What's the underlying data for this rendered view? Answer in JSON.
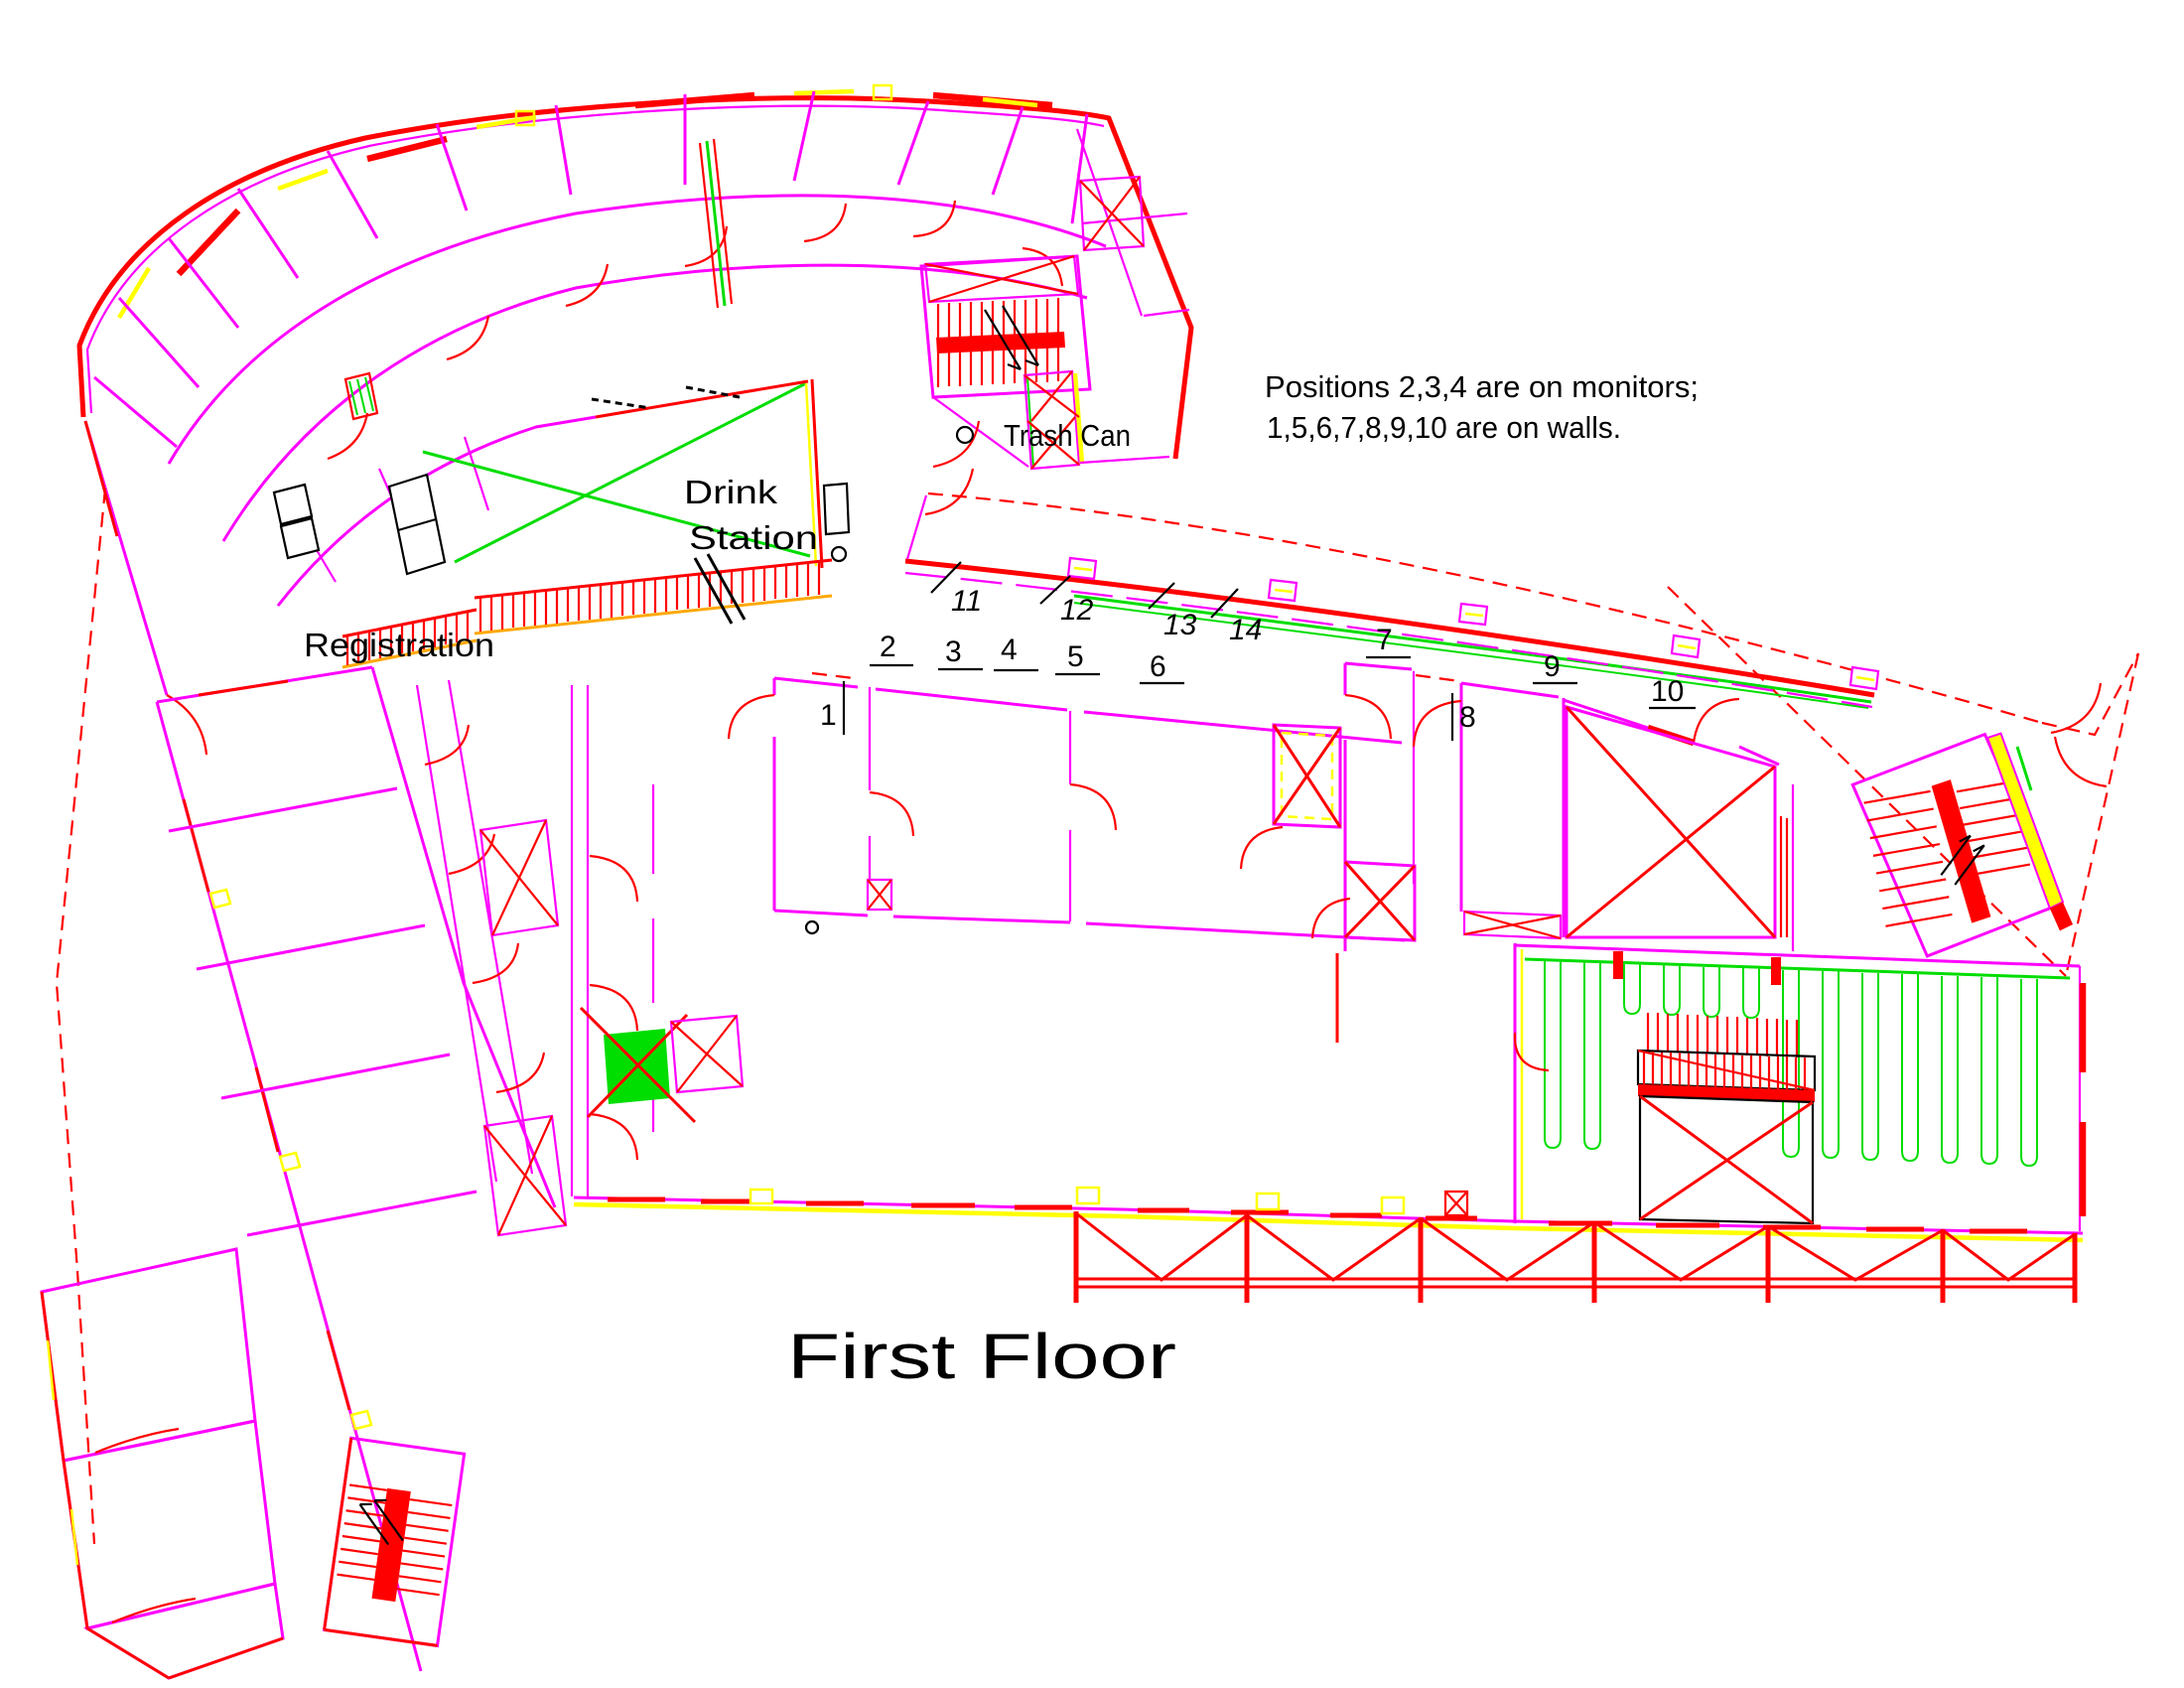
{
  "drawing_title": "First Floor",
  "notes": {
    "line1": "Positions 2,3,4 are on monitors;",
    "line2": "1,5,6,7,8,9,10 are on walls."
  },
  "legend": {
    "trash_can_label": "Trash Can"
  },
  "rooms": {
    "registration_label": "Registration",
    "drink_station_line1": "Drink",
    "drink_station_line2": "Station"
  },
  "positions": {
    "p1": "1",
    "p2": "2",
    "p3": "3",
    "p4": "4",
    "p5": "5",
    "p6": "6",
    "p7": "7",
    "p8": "8",
    "p9": "9",
    "p10": "10",
    "p11": "11",
    "p12": "12",
    "p13": "13",
    "p14": "14"
  },
  "colors": {
    "interior_wall": "#FF00FF",
    "exterior_wall": "#FF0000",
    "site_green": "#00DD00",
    "window_yellow": "#FFFF00",
    "band_orange": "#FFA800",
    "annotation_black": "#000000"
  }
}
